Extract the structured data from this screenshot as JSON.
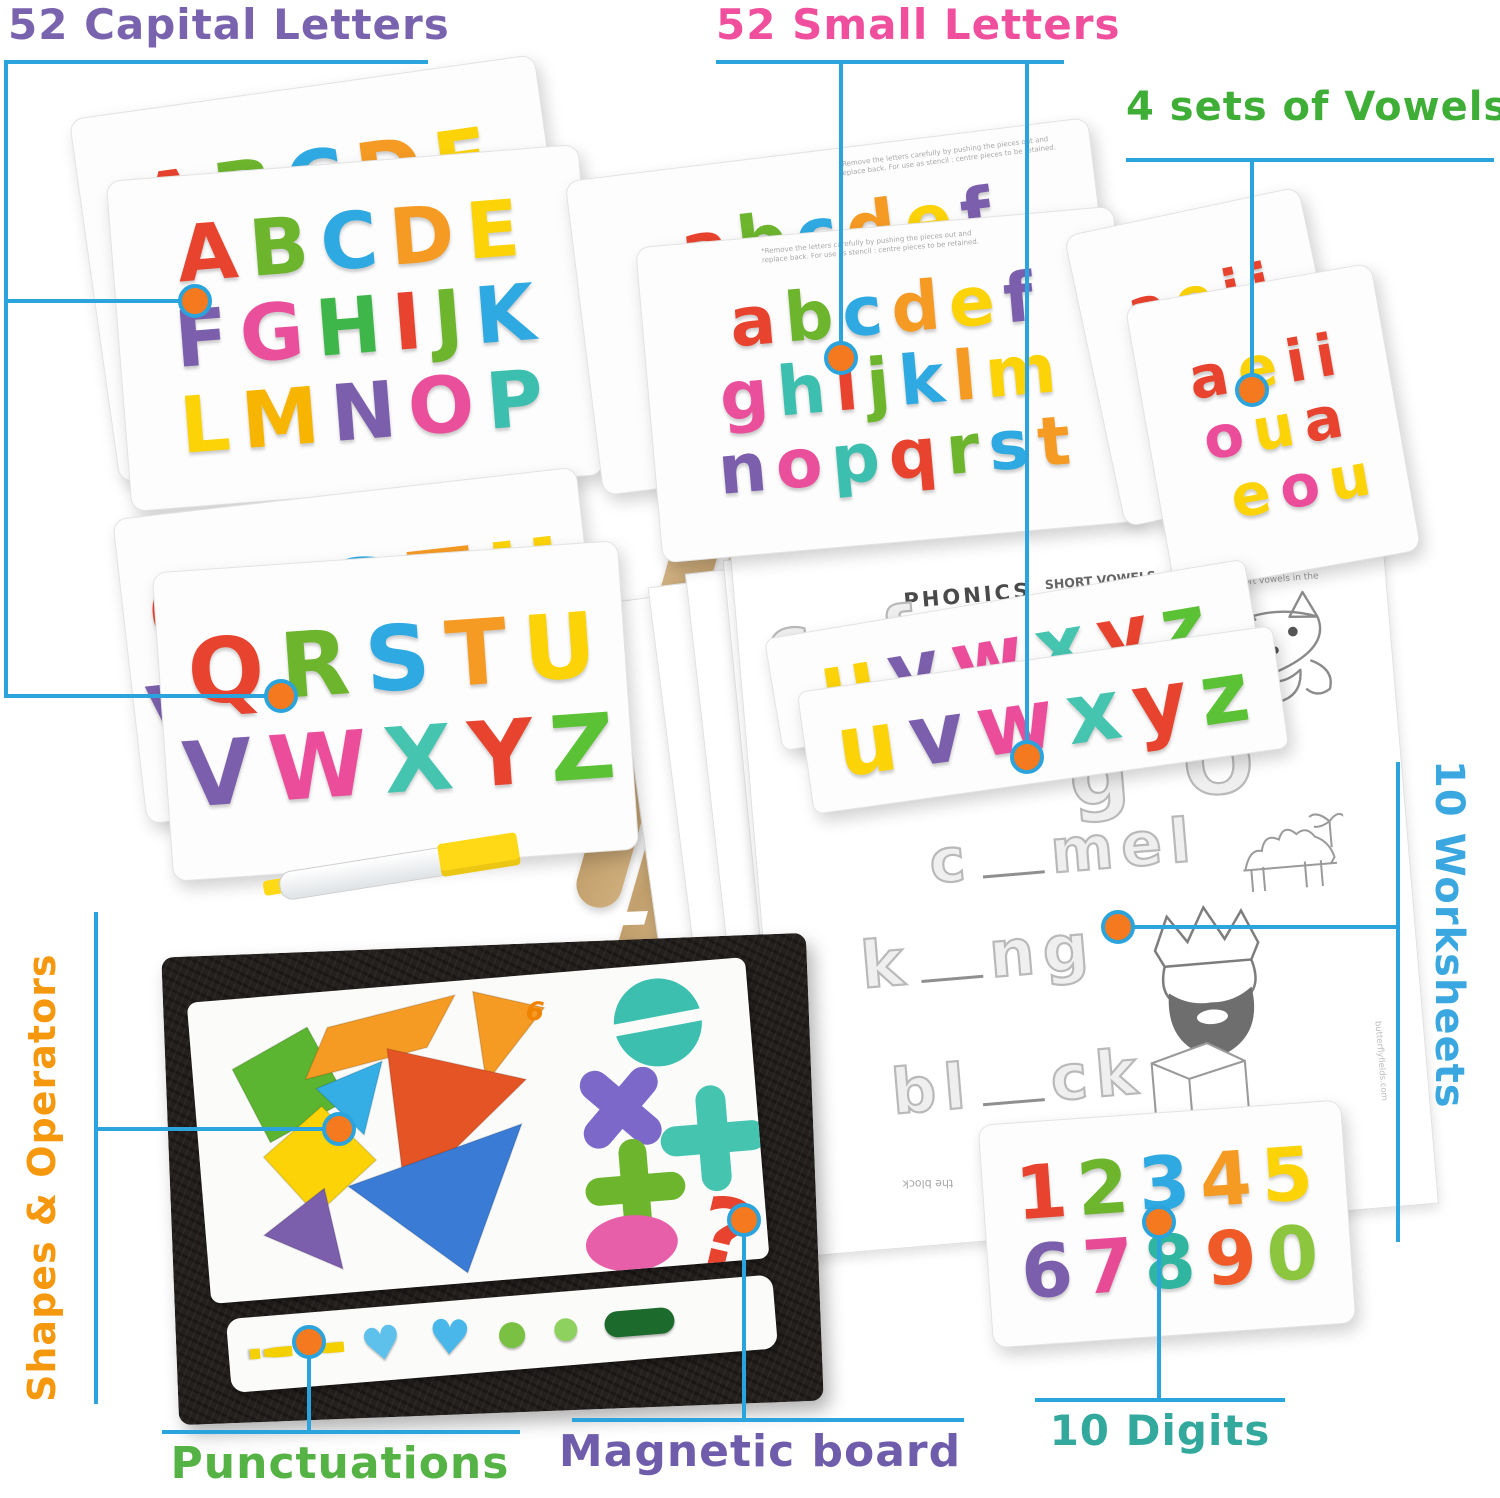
{
  "colors": {
    "callout_line": "#2ba3dc",
    "dot_fill": "#f4791f",
    "background": "#ffffff"
  },
  "callouts": {
    "capital": {
      "label": "52 Capital Letters",
      "color": "#7a63ae"
    },
    "small": {
      "label": "52 Small Letters",
      "color": "#ef4f9d"
    },
    "vowels": {
      "label": "4 sets of Vowels",
      "color": "#3fae37"
    },
    "worksheets": {
      "label": "10 Worksheets",
      "color": "#3aa7e0"
    },
    "shapes": {
      "label": "Shapes & Operators",
      "color": "#f6980e"
    },
    "punctuations": {
      "label": "Punctuations",
      "color": "#55b345"
    },
    "magnetic": {
      "label": "Magnetic board",
      "color": "#6f5caa"
    },
    "digits": {
      "label": "10 Digits",
      "color": "#33a99d"
    }
  },
  "fine_print": "*Remove the letters carefully by pushing the pieces out and replace back. For use as stencil : centre pieces to be retained.",
  "letter_boards": {
    "capital_back": {
      "rows": [
        [
          "A",
          "B",
          "C",
          "D",
          "E"
        ],
        [
          "F",
          "G",
          "H",
          "I",
          "J",
          "K"
        ],
        [
          "L",
          "M",
          "N",
          "O",
          "P"
        ]
      ]
    },
    "capital_front": {
      "rows": [
        [
          "A",
          "B",
          "C",
          "D",
          "E"
        ],
        [
          "F",
          "G",
          "H",
          "I",
          "J",
          "K"
        ],
        [
          "L",
          "M",
          "N",
          "O",
          "P"
        ]
      ]
    },
    "small_back": {
      "rows": [
        [
          "a",
          "b",
          "c",
          "d",
          "e",
          "f"
        ],
        [
          "g",
          "h",
          "i",
          "j",
          "k",
          "l",
          "m"
        ],
        [
          "n",
          "o",
          "p",
          "q",
          "r",
          "s",
          "t"
        ]
      ]
    },
    "small_front": {
      "rows": [
        [
          "a",
          "b",
          "c",
          "d",
          "e",
          "f"
        ],
        [
          "g",
          "h",
          "i",
          "j",
          "k",
          "l",
          "m"
        ],
        [
          "n",
          "o",
          "p",
          "q",
          "r",
          "s",
          "t"
        ]
      ]
    },
    "qrstu_back": {
      "rows": [
        [
          "Q",
          "R",
          "S",
          "T",
          "U"
        ],
        [
          "V",
          "W",
          "X",
          "Y",
          "Z"
        ]
      ]
    },
    "qrstu_front": {
      "rows": [
        [
          "Q",
          "R",
          "S",
          "T",
          "U"
        ],
        [
          "V",
          "W",
          "X",
          "Y",
          "Z"
        ]
      ]
    },
    "vowel_back": {
      "rows": [
        [
          "a",
          "e",
          "i",
          "i"
        ],
        [
          "o",
          "u",
          "a"
        ],
        [
          "e",
          "o",
          "u"
        ]
      ]
    },
    "vowel_front": {
      "rows": [
        [
          "a",
          "e",
          "i",
          "i"
        ],
        [
          "o",
          "u",
          "a"
        ],
        [
          "e",
          "o",
          "u"
        ]
      ]
    },
    "strip_back": {
      "rows": [
        [
          "u",
          "v",
          "w",
          "x",
          "y",
          "z"
        ]
      ]
    },
    "strip_front": {
      "rows": [
        [
          "u",
          "v",
          "w",
          "x",
          "y",
          "z"
        ]
      ]
    },
    "digits": {
      "rows": [
        [
          "1",
          "2",
          "3",
          "4",
          "5"
        ],
        [
          "6",
          "7",
          "8",
          "9",
          "0"
        ]
      ]
    }
  },
  "board_colors": {
    "capital_back": [
      [
        "#e8432e",
        "#6cb52d",
        "#2ea9e1",
        "#f59a23",
        "#fcd307"
      ],
      [
        "#7c5fac",
        "#ea4f9b",
        "#3eb649",
        "#e8432e",
        "#6cb52d",
        "#2ea9e1"
      ],
      [
        "#f59a23",
        "#fcd307",
        "#7c5fac",
        "#ea4f9b",
        "#3cbfae"
      ]
    ],
    "capital_front": [
      [
        "#e8432e",
        "#6cb52d",
        "#2ea9e1",
        "#f59a23",
        "#fcd307"
      ],
      [
        "#7c5fac",
        "#ea4f9b",
        "#3eb649",
        "#e8432e",
        "#6cb52d",
        "#2ea9e1"
      ],
      [
        "#fcd307",
        "#f8b500",
        "#7c5fac",
        "#ea4f9b",
        "#3cbfae"
      ]
    ],
    "small_back": [
      [
        "#e8432e",
        "#6cb52d",
        "#2ea9e1",
        "#f59a23",
        "#fcd307",
        "#7c5fac"
      ],
      [
        "#ea4f9b",
        "#3cbfae",
        "#e8432e",
        "#6cb52d",
        "#2ea9e1",
        "#f59a23",
        "#fcd307"
      ],
      [
        "#7c5fac",
        "#ea4f9b",
        "#3cbfae",
        "#e8432e",
        "#6cb52d",
        "#2ea9e1",
        "#f59a23"
      ]
    ],
    "small_front": [
      [
        "#e8432e",
        "#6cb52d",
        "#2ea9e1",
        "#f59a23",
        "#fcd307",
        "#7c5fac"
      ],
      [
        "#ea4f9b",
        "#3cbfae",
        "#e8432e",
        "#6cb52d",
        "#2ea9e1",
        "#f59a23",
        "#fcd307"
      ],
      [
        "#7c5fac",
        "#ea4f9b",
        "#3cbfae",
        "#e8432e",
        "#6cb52d",
        "#2ea9e1",
        "#f59a23"
      ]
    ],
    "qrstu_back": [
      [
        "#e8432e",
        "#6cb52d",
        "#2ea9e1",
        "#f59a23",
        "#fcd307"
      ],
      [
        "#7c5fac",
        "#ec4d9b",
        "#45c4b0",
        "#e8432e",
        "#5bc235"
      ]
    ],
    "qrstu_front": [
      [
        "#e8432e",
        "#6cb52d",
        "#2ea9e1",
        "#f59a23",
        "#fcd307"
      ],
      [
        "#7c5fac",
        "#ec4d9b",
        "#45c4b0",
        "#e8432e",
        "#5bc235"
      ]
    ],
    "vowel_back": [
      [
        "#e8432e",
        "#fcd307",
        "#e8432e",
        "#e8432e"
      ],
      [
        "#ec4d9b",
        "#fcd307",
        "#e8432e"
      ],
      [
        "#fcd307",
        "#ec4d9b",
        "#fcd307"
      ]
    ],
    "vowel_front": [
      [
        "#e8432e",
        "#fcd307",
        "#e8432e",
        "#e8432e"
      ],
      [
        "#ec4d9b",
        "#fcd307",
        "#e8432e"
      ],
      [
        "#fcd307",
        "#ec4d9b",
        "#fcd307"
      ]
    ],
    "strip_back": [
      [
        "#fcd307",
        "#7c5fac",
        "#ec4d9b",
        "#45c4b0",
        "#e8432e",
        "#5bc235"
      ]
    ],
    "strip_front": [
      [
        "#fcd307",
        "#7c5fac",
        "#ec4d9b",
        "#45c4b0",
        "#e8432e",
        "#5bc235"
      ]
    ],
    "digits": [
      [
        "#e8432e",
        "#6cb52d",
        "#2ea9e1",
        "#f59a23",
        "#fcd307"
      ],
      [
        "#7c5fac",
        "#e74b96",
        "#2fb5a0",
        "#f05a28",
        "#8cc63f"
      ]
    ]
  },
  "punctuation_items": [
    {
      "type": "glyph",
      "glyph": "!",
      "color": "#f5d000",
      "size": 58,
      "rot": 90
    },
    {
      "type": "glyph",
      "glyph": "!",
      "color": "#f5d000",
      "size": 58,
      "rot": 90
    },
    {
      "type": "glyph",
      "glyph": "♥",
      "color": "#5ec1ec",
      "size": 46,
      "rot": -6
    },
    {
      "type": "glyph",
      "glyph": "♥",
      "color": "#49b7ea",
      "size": 48,
      "rot": 6
    },
    {
      "type": "glyph",
      "glyph": "●",
      "color": "#7ac143",
      "size": 34,
      "rot": 0
    },
    {
      "type": "glyph",
      "glyph": "●",
      "color": "#8ed15e",
      "size": 30,
      "rot": 0
    },
    {
      "type": "bar",
      "color": "#1c6b2d",
      "width": 70,
      "height": 26
    }
  ],
  "tangram": {
    "logo": "6",
    "shapes": [
      {
        "name": "green-square",
        "points": "40,70 118,34 152,110 72,146",
        "fill": "#5cb531"
      },
      {
        "name": "orange-parallelogram",
        "points": "138,36 268,14 236,64 112,86",
        "fill": "#f59a23"
      },
      {
        "name": "orange-triangle",
        "points": "286,12 356,34 292,104",
        "fill": "#f59a23"
      },
      {
        "name": "blue-triangle-small",
        "points": "122,96 190,74 166,146",
        "fill": "#35aee5"
      },
      {
        "name": "yellow-diamond",
        "points": "64,160 126,114 176,172 112,222",
        "fill": "#fcd307"
      },
      {
        "name": "red-triangle-large",
        "points": "196,62 332,104 202,212",
        "fill": "#e55425"
      },
      {
        "name": "purple-triangle",
        "points": "58,238 122,196 134,278",
        "fill": "#7c5fac"
      },
      {
        "name": "blue-triangle-large",
        "points": "146,196 324,148 258,292",
        "fill": "#3a7bd5"
      }
    ],
    "operators": [
      {
        "name": "divide-circle",
        "type": "circle",
        "cx": 468,
        "cy": 58,
        "r": 44,
        "fill": "#3cbfae"
      },
      {
        "name": "multiply-sign",
        "type": "cross",
        "cx": 424,
        "cy": 140,
        "arm": 34,
        "rot": 45,
        "stroke": "#7b68c8",
        "w": 30
      },
      {
        "name": "plus-sign-teal",
        "type": "cross",
        "cx": 514,
        "cy": 178,
        "arm": 38,
        "rot": 0,
        "stroke": "#45c4b0",
        "w": 30
      },
      {
        "name": "plus-sign-green",
        "type": "cross",
        "cx": 432,
        "cy": 222,
        "arm": 36,
        "rot": 0,
        "stroke": "#6cb52d",
        "w": 28
      },
      {
        "name": "pink-oval",
        "type": "ellipse",
        "cx": 424,
        "cy": 276,
        "rx": 46,
        "ry": 28,
        "fill": "#e75fa8"
      },
      {
        "name": "question-mark",
        "type": "text",
        "x": 482,
        "y": 298,
        "glyph": "?",
        "fill": "#e8432e",
        "size": 96,
        "rot": 18
      }
    ]
  },
  "worksheet": {
    "brand_glyph": "6",
    "title": "PHONICS",
    "subtitle": "SHORT VOWELS - a, e, i, o, u",
    "instruction": "Say each picture word. Write the missing short vowels in the spaces below.",
    "stack_header": "PH",
    "trace_top": [
      "c",
      "f"
    ],
    "trace_mid": [
      "g",
      "O"
    ],
    "exercises": [
      {
        "pre": "c",
        "post": "mel"
      },
      {
        "pre": "k",
        "post": "ng"
      },
      {
        "pre": "bl",
        "post": "ck"
      }
    ],
    "flipped_text": "the block",
    "footer_small": "butterflyfields.com"
  }
}
